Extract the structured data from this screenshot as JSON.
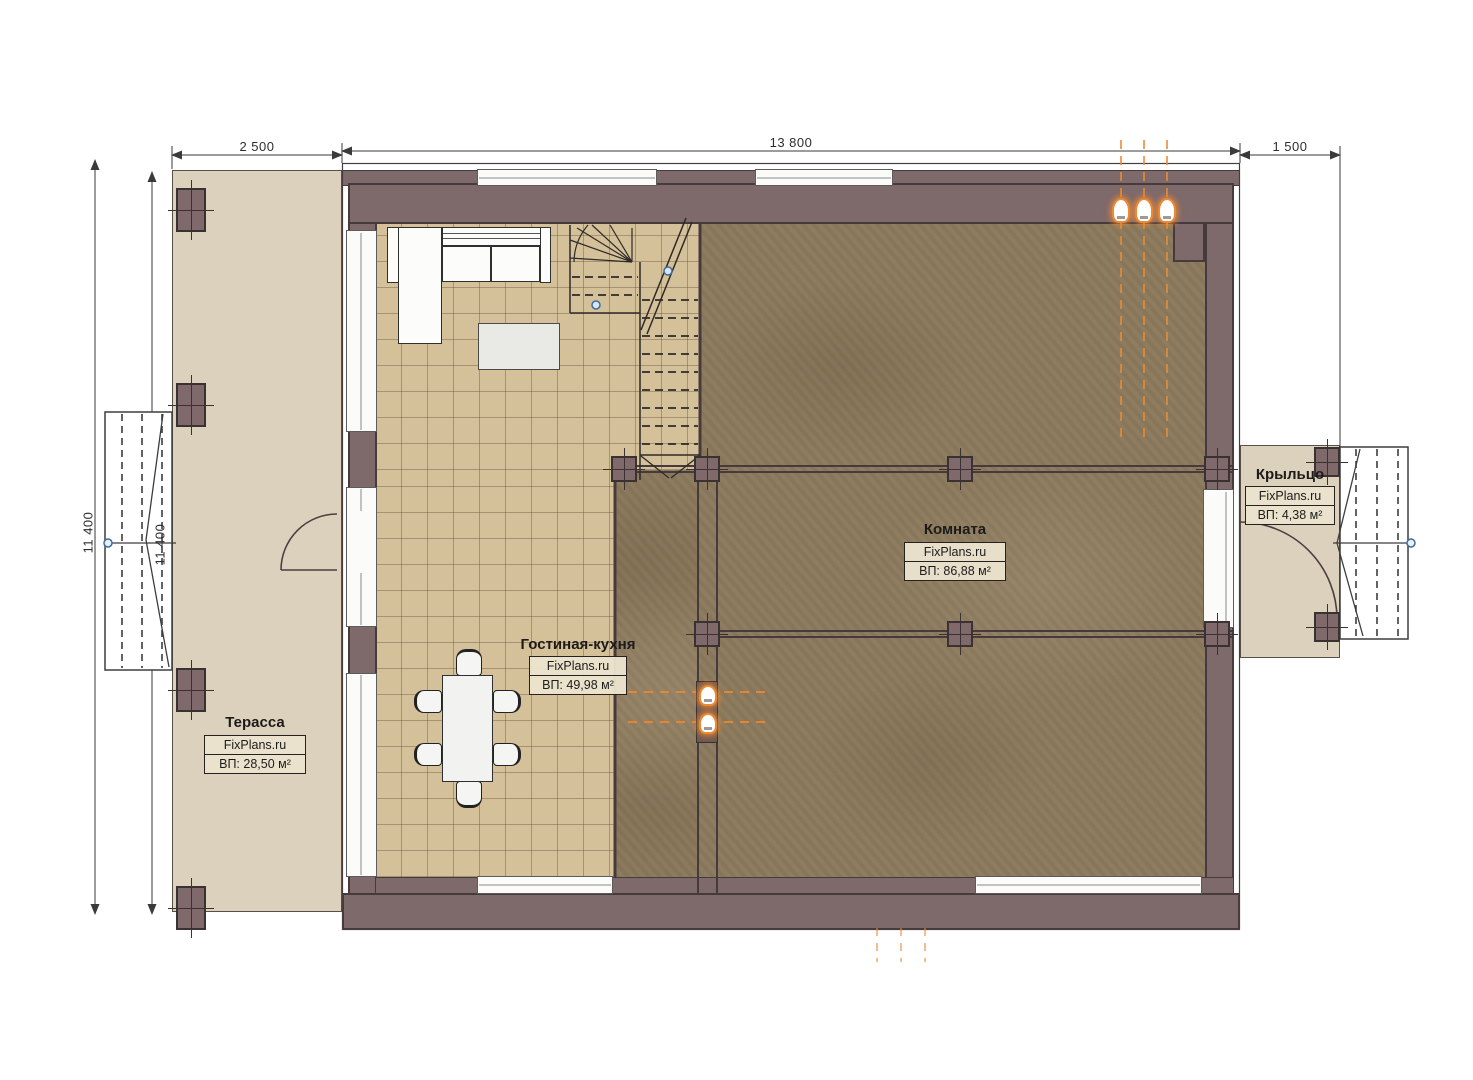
{
  "document": {
    "type": "floor-plan",
    "brand": "FixPlans.ru"
  },
  "dimensions": {
    "top_left": "2 500",
    "top_middle": "13 800",
    "top_right": "1 500",
    "left_outer": "11 400",
    "left_inner": "11 400"
  },
  "rooms": {
    "terrace": {
      "name": "Терасса",
      "brand": "FixPlans.ru",
      "area": "ВП: 28,50 м²"
    },
    "living_kitchen": {
      "name": "Гостиная-кухня",
      "brand": "FixPlans.ru",
      "area": "ВП: 49,98 м²"
    },
    "room": {
      "name": "Комната",
      "brand": "FixPlans.ru",
      "area": "ВП: 86,88 м²"
    },
    "porch": {
      "name": "Крыльцо",
      "brand": "FixPlans.ru",
      "area": "ВП: 4,38 м²"
    }
  },
  "colors": {
    "wall": "#7e696b",
    "wall_edge": "#463a3c",
    "terrace_floor": "#dcd1bd",
    "tile_floor": "#d5c199",
    "room_floor": "#8c7a5d",
    "accent_orange": "#ec8a33",
    "line": "#3a3a3a"
  }
}
